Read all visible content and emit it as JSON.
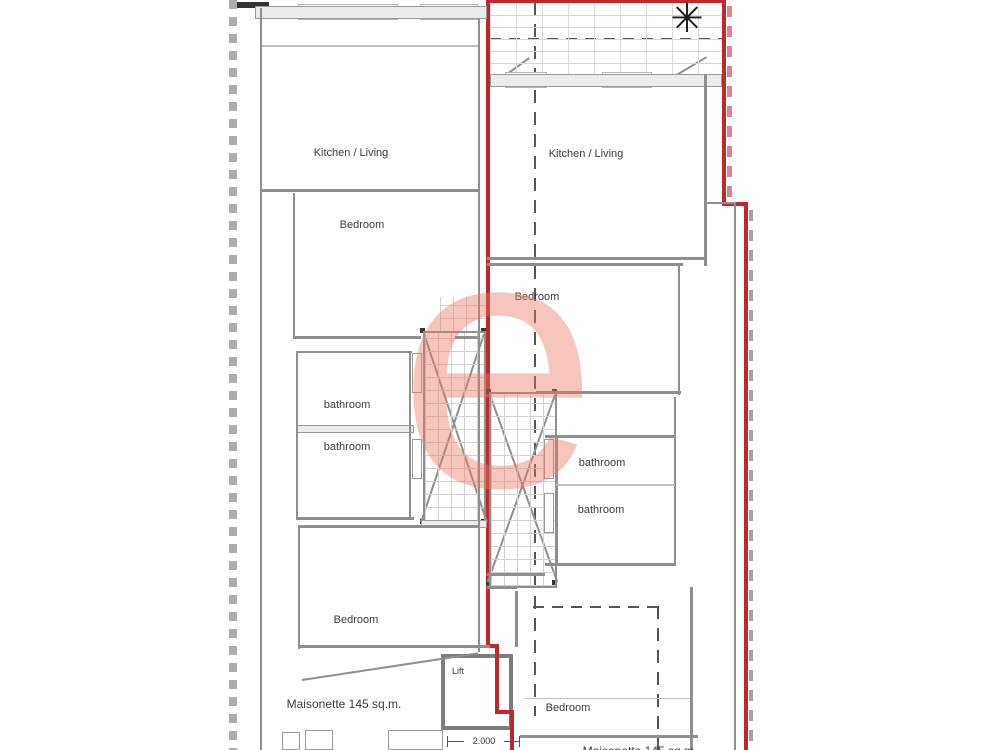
{
  "document": {
    "type": "architectural-floor-plan"
  },
  "units": {
    "left": {
      "kitchen_living": "Kitchen / Living",
      "bedroom_top": "Bedroom",
      "bathroom_upper": "bathroom",
      "bathroom_lower": "bathroom",
      "bedroom_bottom": "Bedroom",
      "area": "Maisonette 145 sq.m.",
      "lift": "Lift",
      "dimension": "2.000"
    },
    "right": {
      "kitchen_living": "Kitchen / Living",
      "bedroom_top": "Bedroom",
      "bathroom_upper": "bathroom",
      "bathroom_lower": "bathroom",
      "bedroom_bottom": "Bedroom",
      "area_partial": "Maisonette 145 sq.m."
    }
  },
  "watermark": {
    "letter": "e",
    "color": "#e87463"
  },
  "icons": {
    "plant": "✳"
  },
  "colors": {
    "boundary_red": "#c1272d",
    "wall_gray": "#8f8f8f",
    "hatch_gray": "#d2d2d2",
    "text": "#3b3b3b"
  }
}
